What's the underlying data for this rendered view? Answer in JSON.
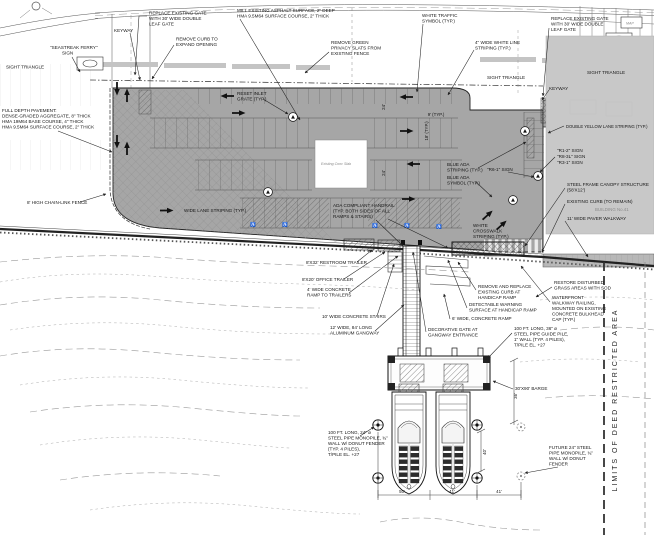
{
  "colors": {
    "lot_gray": "#a6a6a6",
    "building_gray": "#c8c8c8",
    "walkway_gray": "#b8b8b8",
    "line": "#1a1a1a"
  },
  "ann": {
    "sight_triangle_left": [
      "SIGHT TRIANGLE"
    ],
    "full_depth_pavement": [
      "FULL DEPTH PAVEMENT:",
      "DENSE-GRADED AGGREGATE, 8\" THICK",
      "HMA 19M64 BASE COURSE, 4\" THICK",
      "HMA 9.5M64 SURFACE COURSE, 2\" THICK"
    ],
    "chain_link_fence": [
      "8' HIGH CHAIN-LINK FENCE"
    ],
    "seastreak_sign": [
      "\"SEASTREAK FERRY\"",
      "SIGN"
    ],
    "keyway_left": [
      "KEYWAY"
    ],
    "replace_gate_left": [
      "REPLACE EXISTING GATE",
      "WITH 30' WIDE DOUBLE",
      "LEAF GATE"
    ],
    "remove_curb": [
      "REMOVE CURB TO",
      "EXPAND OPENING"
    ],
    "mill_asphalt": [
      "MILL EXISTING ASPHALT SURFACE, 2\" DEEP",
      "HMA 9.5M64 SURFACE COURSE, 2\" THICK"
    ],
    "white_traffic_symbol": [
      "WHITE TRAFFIC",
      "SYMBOL (TYP.)"
    ],
    "remove_green_slats": [
      "REMOVE GREEN",
      "PRIVACY SLATS FROM",
      "EXISTING FENCE"
    ],
    "white_line_striping": [
      "4\" WIDE WHITE LINE",
      "STRIPING (TYP.)"
    ],
    "replace_gate_right": [
      "REPLACE EXISTING GATE",
      "WITH 30' WIDE DOUBLE",
      "LEAF GATE"
    ],
    "sight_triangle_mid": [
      "SIGHT TRIANGLE"
    ],
    "sight_triangle_right": [
      "SIGHT TRIANGLE"
    ],
    "keyway_right": [
      "KEYWAY"
    ],
    "map_label": [
      "MAP"
    ],
    "reset_inlet": [
      "RESET INLET",
      "GRATE (TYP.)"
    ],
    "existing_slab": [
      "Existing Conc Slab"
    ],
    "ada_striping": [
      "BLUE ADA",
      "STRIPING (TYP.)"
    ],
    "ada_symbol": [
      "BLUE ADA",
      "SYMBOL (TYP.)"
    ],
    "r6_sign": [
      "\"R6-1\" SIGN"
    ],
    "lane_striping": [
      "WIDE LANE STRIPING (TYP.)"
    ],
    "ada_handrail": [
      "ADA COMPLIANT HANDRAIL",
      "(TYP. BOTH SIDES OF ALL",
      "RAMPS & STAIRS)"
    ],
    "crosswalk": [
      "WHITE",
      "CROSSWALK",
      "STRIPING (TYP.)"
    ],
    "double_yellow": [
      "DOUBLE YELLOW LANE STRIPING (TYP.)"
    ],
    "sign_r1": [
      "\"R1-2\" SIGN"
    ],
    "sign_r8": [
      "\"R8-3L\" SIGN"
    ],
    "sign_r3": [
      "\"R3-1\" SIGN"
    ],
    "canopy": [
      "STEEL FRAME CANOPY STRUCTURE",
      "(58'X12')"
    ],
    "existing_curb": [
      "EXISTING CURB (TO REMAIN)"
    ],
    "building": [
      "BUILDING No.41"
    ],
    "paver_walkway": [
      "11' WIDE PAVER WALKWAY"
    ],
    "restroom_trailer": [
      "8'X32' RESTROOM TRAILER"
    ],
    "office_trailer": [
      "8'X20' OFFICE TRAILER"
    ],
    "ramp_trailers": [
      "4' WIDE CONCRETE",
      "RAMP TO TRAILERS"
    ],
    "concrete_stairs": [
      "10' WIDE CONCRETE STAIRS"
    ],
    "gangway": [
      "12' WIDE, 84' LONG",
      "ALUMINUM GANGWAY"
    ],
    "remove_replace_curb": [
      "REMOVE AND REPLACE",
      "EXISTING CURB AT",
      "HANDICAP RAMP"
    ],
    "detectable_warning": [
      "DETECTABLE WARNING",
      "SURFACE AT HANDICAP RAMP"
    ],
    "six_ramp": [
      "6' WIDE, CONCRETE RAMP"
    ],
    "restore_sod": [
      "RESTORE DISTURBED",
      "GRASS AREAS WITH SOD"
    ],
    "railing": [
      "WATERFRONT",
      "WALKWAY RAILING,",
      "MOUNTED ON EXISTING",
      "CONCRETE BULKHEAD",
      "CAP (TYP.)"
    ],
    "decorative_gate": [
      "DECORATIVE GATE AT",
      "GANGWAY ENTRANCE"
    ],
    "guide_pile": [
      "100 FT. LONG, 36\" ø",
      "STEEL PIPE GUIDE PILE,",
      "1\" WALL (TYP. 4 PILES),",
      "T/PILE EL. +27"
    ],
    "barge": [
      "30'X90' BARGE"
    ],
    "monopile": [
      "100 FT. LONG, 24\" ø",
      "STEEL PIPE MONOPILE, ¾\"",
      "WALL W/ DONUT FENDER",
      "(TYP. 4 PILES),",
      "T/PILE EL. +27"
    ],
    "future_pile": [
      "FUTURE 24\" STEEL",
      "PIPE MONOPILE, ¾\"",
      "WALL W/ DONUT",
      "FENDER"
    ],
    "limits": [
      "LIMITS OF DEED RESTRICTED AREA"
    ]
  },
  "dims": {
    "d24a": "24'",
    "d24b": "24'",
    "d9": "9' (TYP.)",
    "d18": "18' (TYP.)",
    "d50": "50'",
    "d41a": "41'",
    "d41b": "41'",
    "d36": "36'",
    "d40": "40'"
  },
  "symbols": {
    "ada": "♿"
  }
}
